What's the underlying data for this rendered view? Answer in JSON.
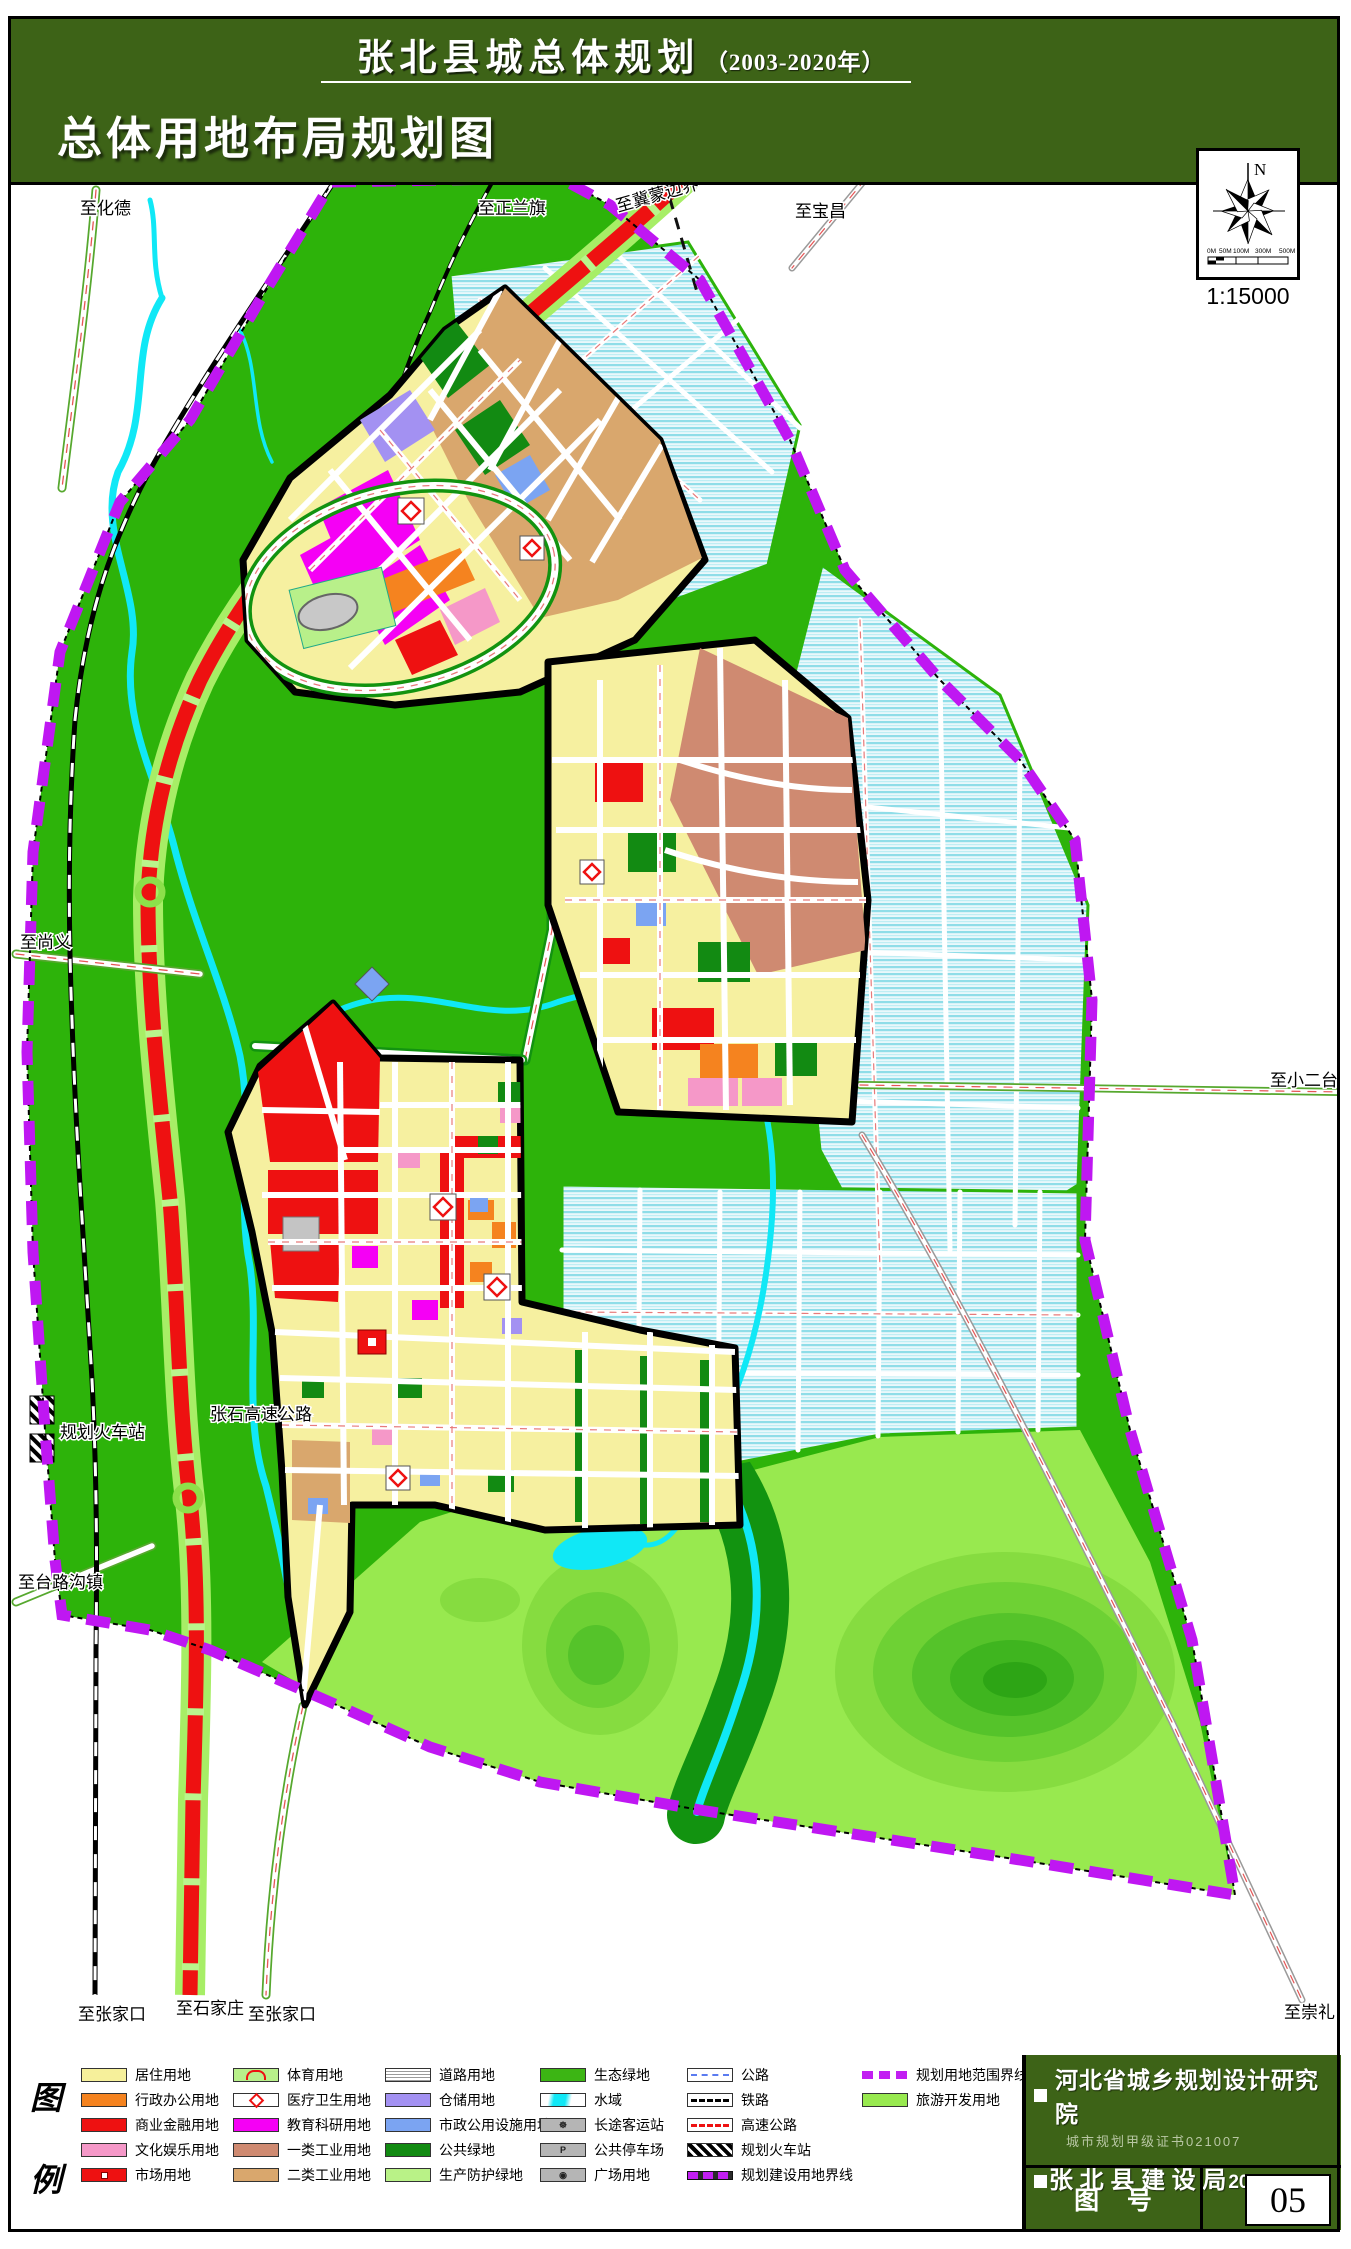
{
  "header": {
    "title": "张北县城总体规划",
    "title_suffix": "（2003-2020年）",
    "subtitle": "总体用地布局规划图"
  },
  "compass": {
    "north": "N",
    "ticks": [
      "0M",
      "50M",
      "100M",
      "300M",
      "500M"
    ],
    "scale": "1:15000"
  },
  "map_labels": {
    "to_huade": "至化德",
    "to_zhenglanqi": "至正兰旗",
    "to_jimeng_border": "至冀蒙边界",
    "to_baochang": "至宝昌",
    "to_shangyi": "至尚义",
    "planned_railway_station": "规划火车站",
    "zhangshi_expressway": "张石高速公路",
    "to_tailugou_town": "至台路沟镇",
    "to_zhangjiakou_rail": "至张家口",
    "to_shijiazhuang": "至石家庄",
    "to_zhangjiakou_road": "至张家口",
    "to_chongli": "至崇礼",
    "to_xiaoertai": "至小二台"
  },
  "legend": {
    "panel": [
      "图",
      "例"
    ],
    "icons": {
      "bus": "☸",
      "parking": "P",
      "plaza": "◉"
    },
    "cols": [
      {
        "items": [
          {
            "label": "居住用地",
            "color": "#f6f09b"
          },
          {
            "label": "行政办公用地",
            "color": "#f5831f"
          },
          {
            "label": "商业金融用地",
            "color": "#ee1111"
          },
          {
            "label": "文化娱乐用地",
            "color": "#f598c8"
          },
          {
            "label": "市场用地",
            "color": "#ee1111"
          }
        ]
      },
      {
        "items": [
          {
            "label": "体育用地",
            "color": "#b8f08a"
          },
          {
            "label": "医疗卫生用地",
            "color": "#ffffff"
          },
          {
            "label": "教育科研用地",
            "color": "#f500f5"
          },
          {
            "label": "一类工业用地",
            "color": "#cf8a71"
          },
          {
            "label": "二类工业用地",
            "color": "#d9a76d"
          }
        ]
      },
      {
        "items": [
          {
            "label": "道路用地",
            "color": "#ffffff"
          },
          {
            "label": "仓储用地",
            "color": "#a391f2"
          },
          {
            "label": "市政公用设施用地",
            "color": "#7ba4f2"
          },
          {
            "label": "公共绿地",
            "color": "#128a12"
          },
          {
            "label": "生产防护绿地",
            "color": "#b9f287"
          }
        ]
      },
      {
        "items": [
          {
            "label": "生态绿地",
            "color": "#3cb514"
          },
          {
            "label": "水域",
            "color": "#10e8f6"
          },
          {
            "label": "长途客运站",
            "color": "#b5b5b5"
          },
          {
            "label": "公共停车场",
            "color": "#b5b5b5"
          },
          {
            "label": "广场用地",
            "color": "#b5b5b5"
          }
        ]
      },
      {
        "items": [
          {
            "label": "公路",
            "color": "#5b7bf0"
          },
          {
            "label": "铁路",
            "color": "#000000"
          },
          {
            "label": "高速公路",
            "color": "#ee1111"
          },
          {
            "label": "规划火车站",
            "color": "#000000"
          },
          {
            "label": "规划建设用地界线",
            "color": "#c21ff2"
          }
        ]
      },
      {
        "items": [
          {
            "label": "规划用地范围界线",
            "color": "#c21ff2"
          },
          {
            "label": "旅游开发用地",
            "color": "#98e94f"
          }
        ]
      }
    ]
  },
  "title_block": {
    "institute": "河北省城乡规划设计研究院",
    "certificate": "城市规划甲级证书021007",
    "bureau": "张 北 县 建 设 局",
    "date": "2005.06",
    "drawing_no_label": "图    号",
    "drawing_no": "05"
  }
}
